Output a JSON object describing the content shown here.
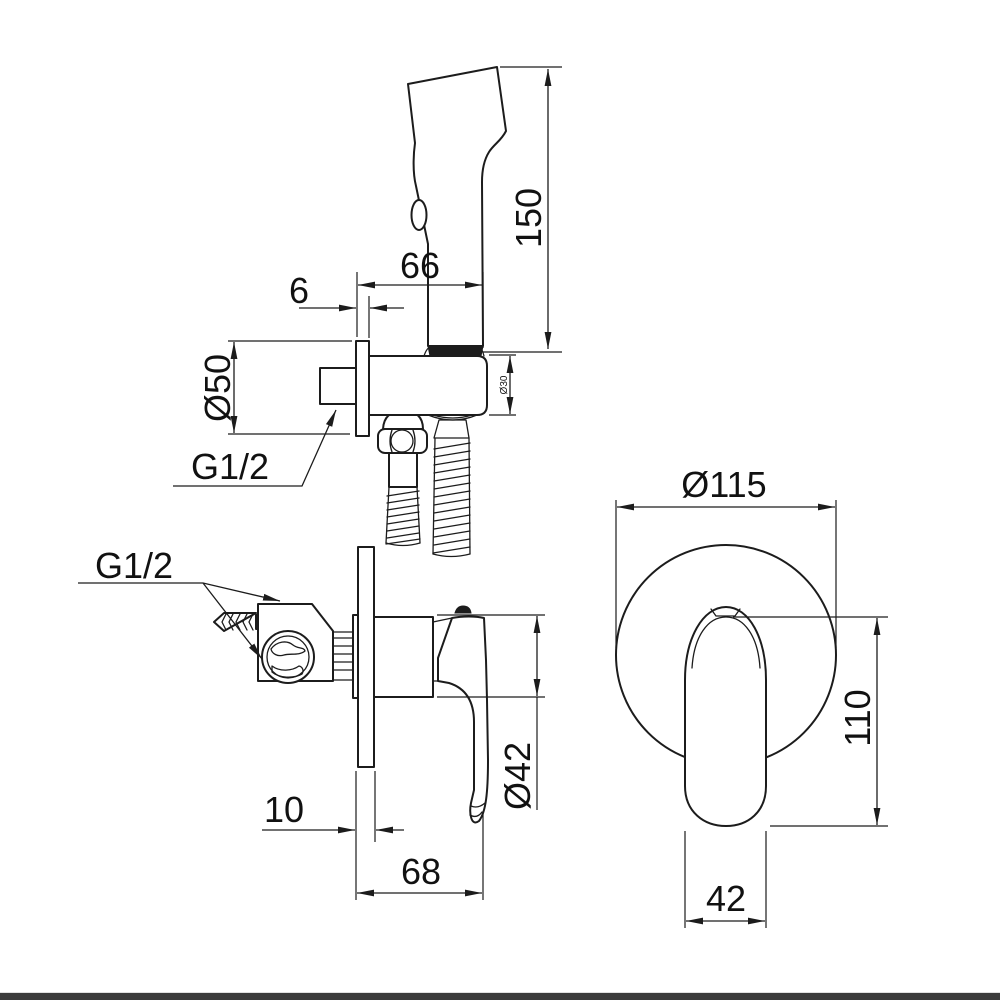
{
  "drawing": {
    "type": "technical-dimension-drawing",
    "subject": "concealed bidet shower set: hand sprayer with wall holder (top), concealed mixer side view (bottom left), mixer front view (bottom right)"
  },
  "dimensions": {
    "shower_height": "150",
    "holder_offset": "66",
    "holder_plate_thickness": "6",
    "holder_escutcheon_diameter": "Ø50",
    "holder_wall_thread": "G1/2",
    "holder_body_diameter": "Ø30",
    "mixer_wall_thread": "G1/2",
    "mixer_plate_thickness": "10",
    "mixer_depth": "68",
    "mixer_body_diameter": "Ø42",
    "mixer_escutcheon_diameter": "Ø115",
    "mixer_handle_length": "110",
    "mixer_handle_width": "42"
  },
  "colors": {
    "line": "#1c1c1c",
    "background": "#ffffff",
    "footer_bar": "#3b3b3b"
  }
}
